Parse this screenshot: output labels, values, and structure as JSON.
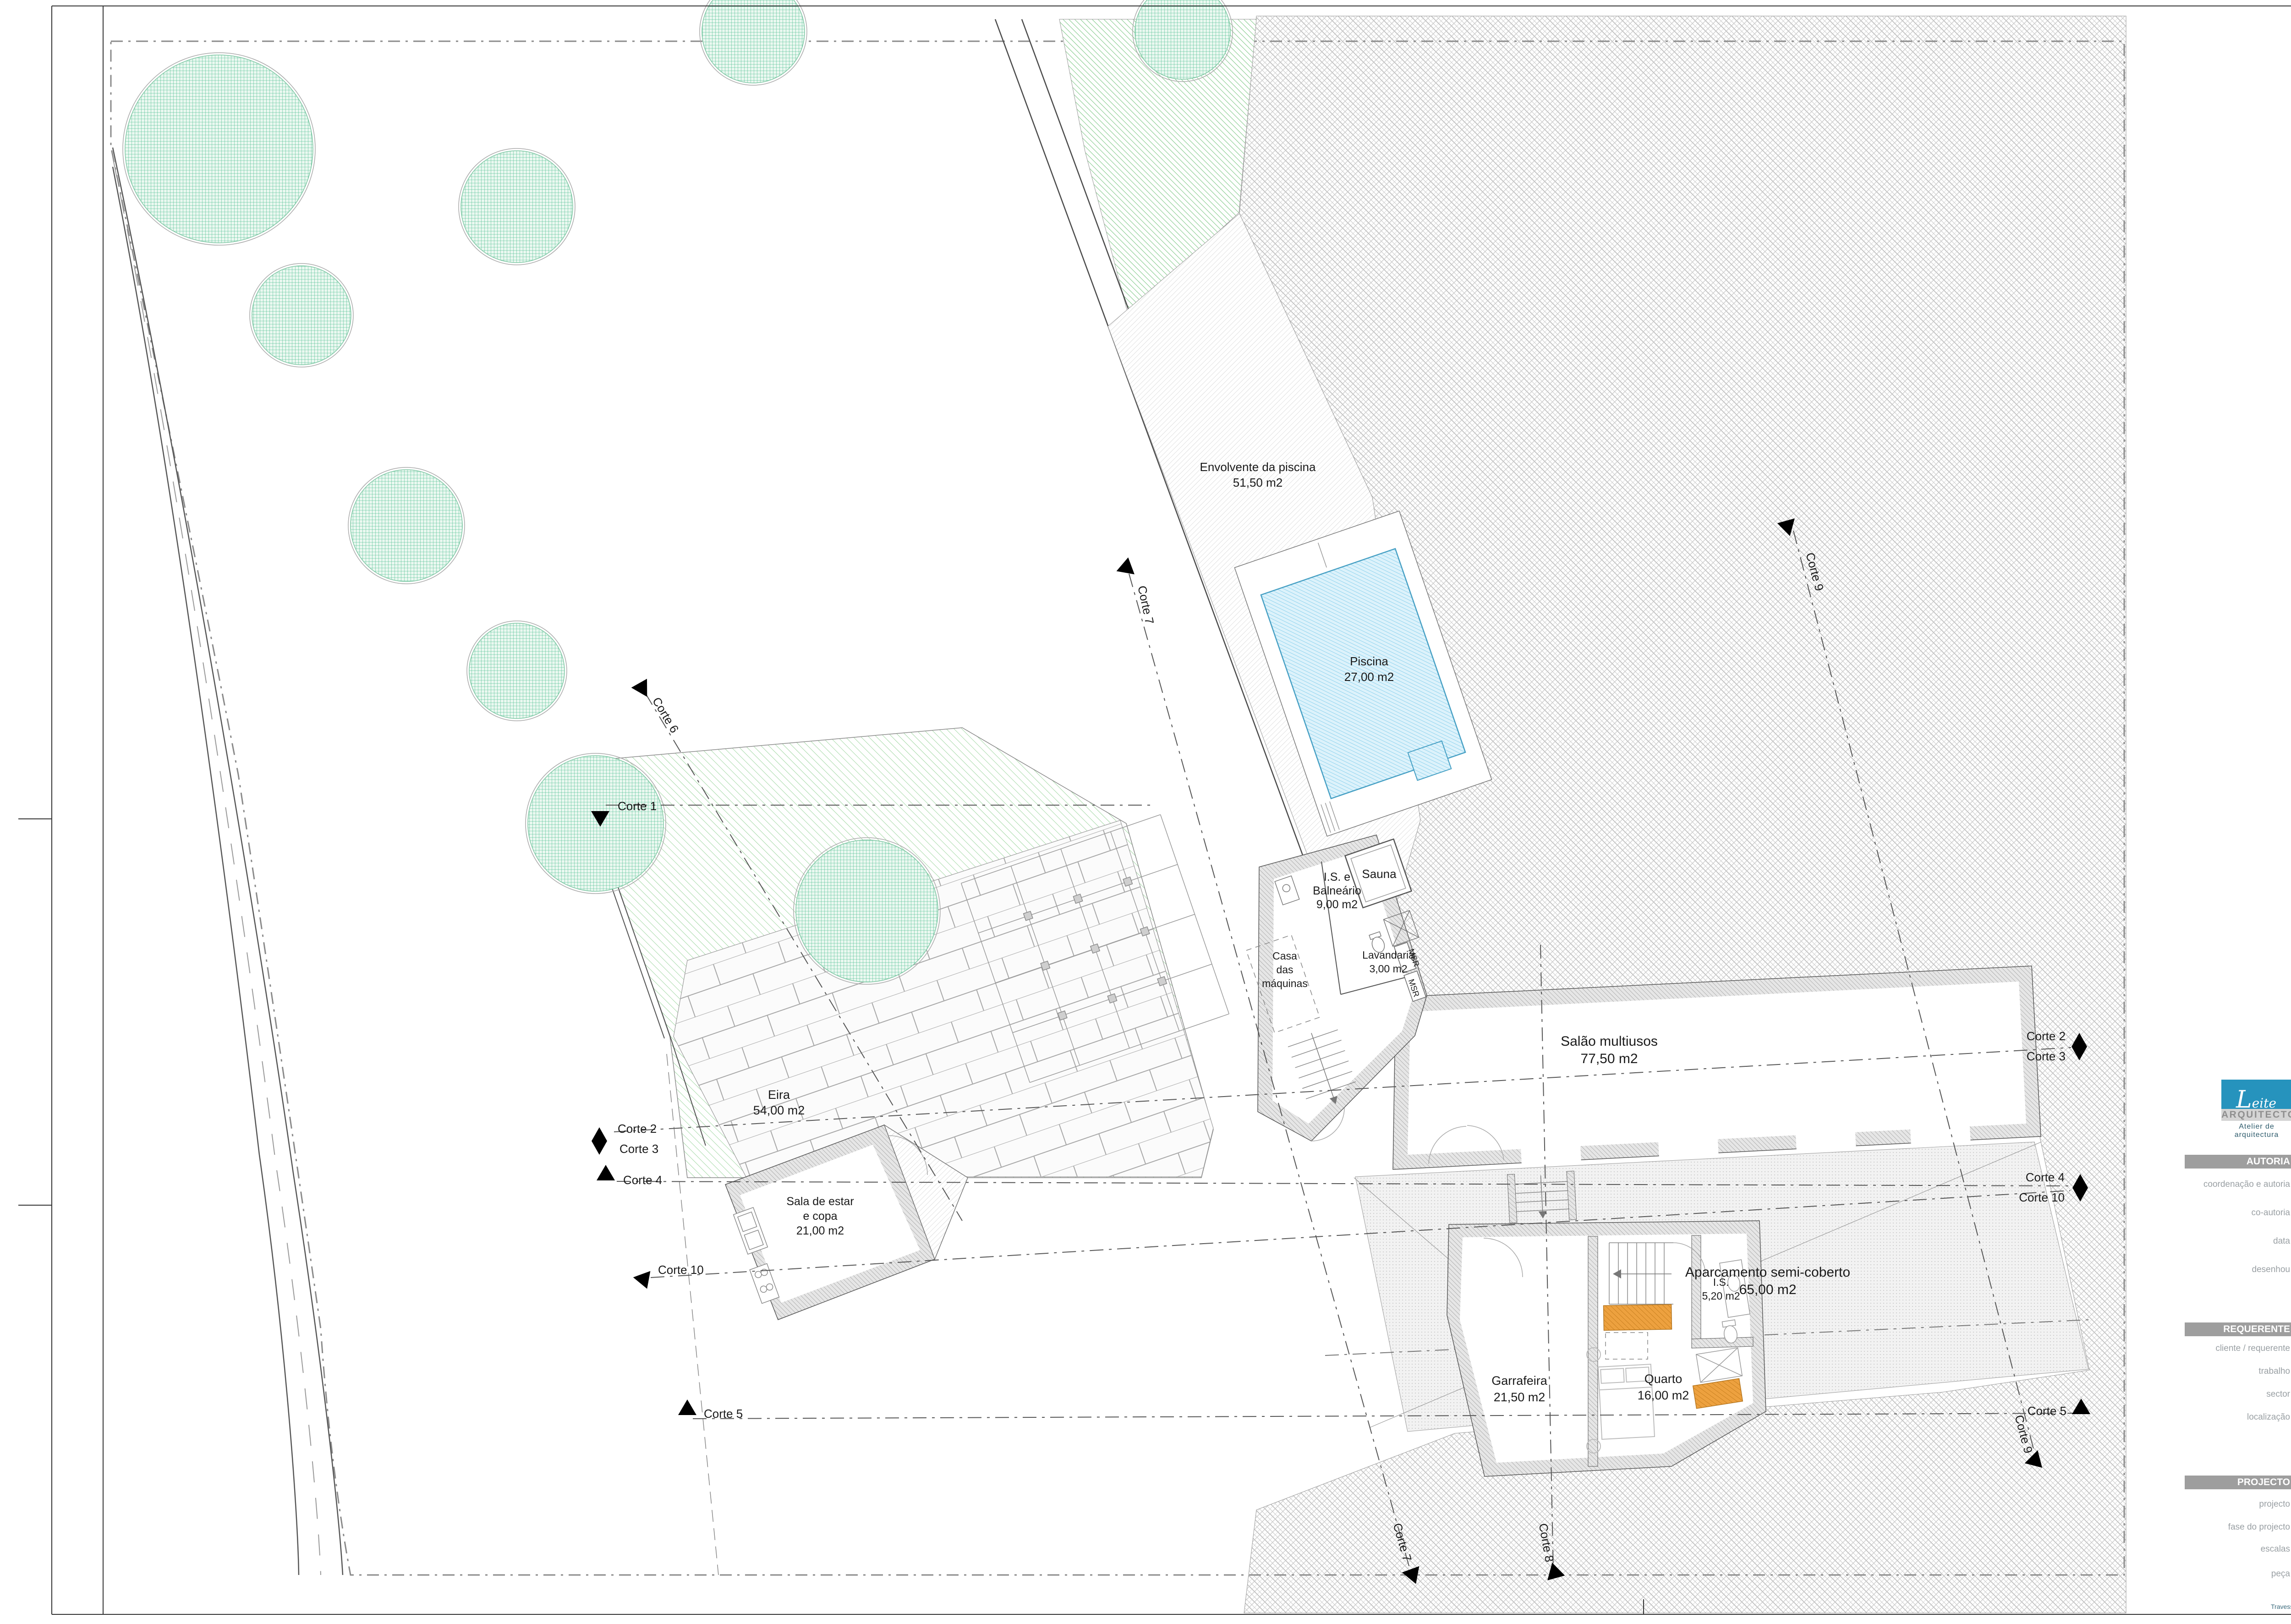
{
  "sheet": {
    "code": "A-05.0",
    "logo": {
      "script": "Leite Oliveira",
      "line1": "ARQUITECTOS",
      "line2": "Atelier de arquitectura"
    },
    "revision": {
      "headers": [
        "Substitui",
        "Data",
        "Motivo"
      ]
    },
    "sections": {
      "autoria": {
        "title": "AUTORIA",
        "rows": [
          {
            "label": "coordenação e autoria",
            "value": "CARLOS OLIVEIRA, ARQUITECTOS"
          },
          {
            "label": "co-autoria",
            "value": ""
          },
          {
            "label": "data",
            "value": "14 / 11 / 2020"
          },
          {
            "label": "desenhou",
            "value": "CARLOS OLIVEIRA"
          }
        ]
      },
      "requerente": {
        "title": "REQUERENTE",
        "value": "ANTÓNIO CARVALHO + CARMEN CAPELO",
        "rows": [
          {
            "label": "cliente / requerente",
            "value": ""
          },
          {
            "label": "trabalho",
            "value": "REMODELAÇÃO DE CASA RURAL"
          },
          {
            "label": "sector",
            "value": ""
          },
          {
            "label": "localização",
            "value": "GOMINHÃES - GUIMARÃES"
          }
        ]
      },
      "projecto": {
        "title": "PROJECTO",
        "rows": [
          {
            "label": "projecto",
            "value": "ARQUITECTURA"
          },
          {
            "label": "fase do projecto",
            "value": "ESTUDO PRÉVIO"
          },
          {
            "label": "escalas",
            "value": "1:100"
          },
          {
            "label": "peça",
            "value": "PROPOSTA - PLANTA PISO -1"
          }
        ]
      }
    },
    "footer": "Travessa da Arcela, nº 45 - 4810 554 COSTA, Guimarães - Portugal Tlf.  +351 964088500  E-mail oliveira1975carlos@gmail.com"
  },
  "plan": {
    "area_labels": [
      {
        "lines": [
          "Envolvente da piscina",
          "51,50 m2"
        ]
      },
      {
        "lines": [
          "Piscina",
          "27,00 m2"
        ]
      },
      {
        "lines": [
          "Salão multiusos",
          "77,50 m2"
        ]
      },
      {
        "lines": [
          "Aparcamento semi-coberto",
          "65,00 m2"
        ]
      },
      {
        "lines": [
          "I.S. e",
          "Balneário",
          "9,00 m2"
        ]
      },
      {
        "lines": [
          "Sauna"
        ]
      },
      {
        "lines": [
          "Lavandaria",
          "3,00 m2"
        ]
      },
      {
        "lines": [
          "Casa",
          "das",
          "máquinas"
        ]
      },
      {
        "lines": [
          "Garrafeira",
          "21,50 m2"
        ]
      },
      {
        "lines": [
          "Quarto",
          "16,00 m2"
        ]
      },
      {
        "lines": [
          "I.S.",
          "5,20 m2"
        ]
      },
      {
        "lines": [
          "Eira",
          "54,00 m2"
        ]
      },
      {
        "lines": [
          "Sala de estar",
          "e copa",
          "21,00 m2"
        ]
      }
    ],
    "equipment_label": "MSR",
    "section_labels": [
      {
        "text": "Corte 1"
      },
      {
        "text": "Corte 6"
      },
      {
        "text": "Corte 2"
      },
      {
        "text": "Corte 3"
      },
      {
        "text": "Corte 4"
      },
      {
        "text": "Corte 10"
      },
      {
        "text": "Corte 5"
      },
      {
        "text": "Corte 7"
      },
      {
        "text": "Corte 9"
      },
      {
        "text": "Corte 2"
      },
      {
        "text": "Corte 3"
      },
      {
        "text": "Corte 4"
      },
      {
        "text": "Corte 10"
      },
      {
        "text": "Corte 5"
      },
      {
        "text": "Corte 7"
      },
      {
        "text": "Corte 8"
      },
      {
        "text": "Corte 9"
      }
    ],
    "colors": {
      "accent_teal": "#2693bd",
      "tree_green": "#46bb8c",
      "lawn_green": "#7cc87f",
      "pool_blue": "#8ed3ee",
      "highlight_orange": "#e0952f"
    }
  }
}
